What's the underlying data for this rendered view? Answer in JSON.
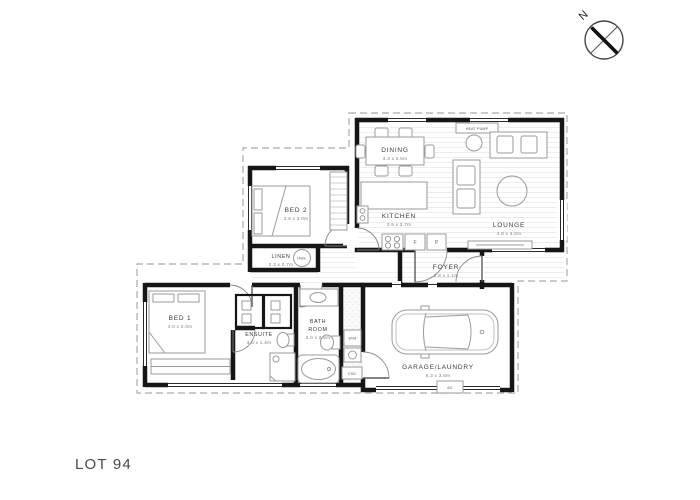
{
  "title": "LOT 94",
  "compass": {
    "north_label": "N"
  },
  "rooms": {
    "bed2": {
      "name": "BED 2",
      "dims": "3.6 x 3.0m"
    },
    "dining": {
      "name": "DINING",
      "dims": "3.4 x 2.5m"
    },
    "kitchen": {
      "name": "KITCHEN",
      "dims": "3.5 x 2.7m"
    },
    "lounge": {
      "name": "LOUNGE",
      "dims": "4.8 x 4.0m"
    },
    "linen": {
      "name": "LINEN",
      "dims": "2.2 x 0.7m"
    },
    "foyer": {
      "name": "FOYER",
      "dims": "2.8 x 1.1m"
    },
    "bed1": {
      "name": "BED 1",
      "dims": "4.0 x 3.0m"
    },
    "ensuite": {
      "name": "ENSUITE",
      "dims": "3.0 x 1.4m"
    },
    "bathroom": {
      "name_line1": "BATH",
      "name_line2": "ROOM",
      "dims": "3.0 x 2.5m"
    },
    "garage": {
      "name": "GARAGE/LAUNDRY",
      "dims": "6.3 x 3.6m"
    }
  },
  "fixtures": {
    "heat_pump": "HEAT PUMP",
    "hwc": "HWC",
    "washing_machine": "W/M",
    "csd": "CSD",
    "ac": "AC",
    "fridge": "F",
    "pantry": "P"
  }
}
